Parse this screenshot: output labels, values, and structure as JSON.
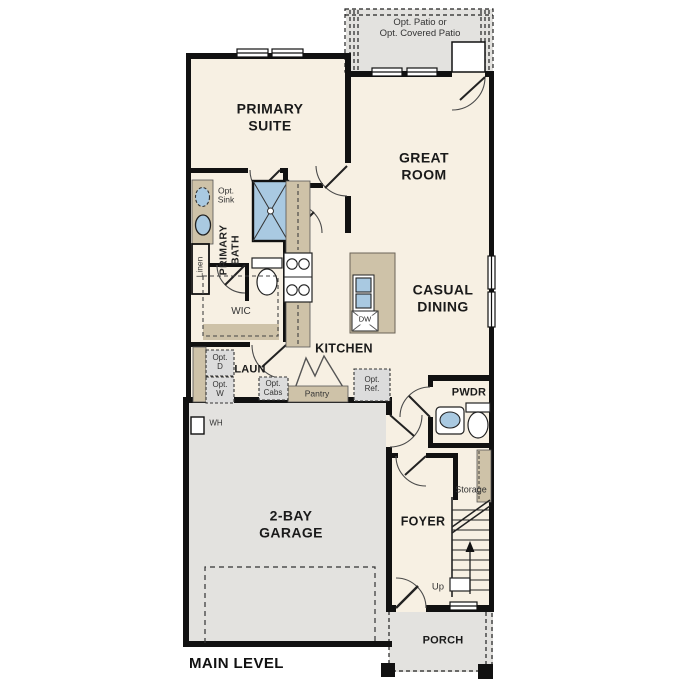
{
  "title": "MAIN LEVEL",
  "patio": {
    "label": "Opt. Patio or\nOpt. Covered Patio"
  },
  "rooms": {
    "primary_suite": "PRIMARY\nSUITE",
    "great_room": "GREAT\nROOM",
    "casual_dining": "CASUAL\nDINING",
    "primary_bath": "PRIMARY\nBATH",
    "wic": "WIC",
    "kitchen": "KITCHEN",
    "laundry": "LAUN",
    "pwdr": "PWDR",
    "foyer": "FOYER",
    "garage": "2-BAY\nGARAGE",
    "porch": "PORCH",
    "storage": "Storage"
  },
  "fixtures": {
    "opt_sink": "Opt.\nSink",
    "linen": "Linen",
    "dw": "DW",
    "opt_d": "Opt.\nD",
    "opt_w": "Opt.\nW",
    "opt_cabs": "Opt.\nCabs",
    "pantry": "Pantry",
    "opt_ref": "Opt.\nRef.",
    "wh": "WH",
    "up": "Up"
  },
  "colors": {
    "wall": "#111111",
    "interior": "#f7f0e3",
    "exterior_concrete": "#e3e2df",
    "cabinet_tan": "#cec2a8",
    "fixture_blue": "#a9c9e1",
    "optional_fill": "#dcdcdc"
  }
}
